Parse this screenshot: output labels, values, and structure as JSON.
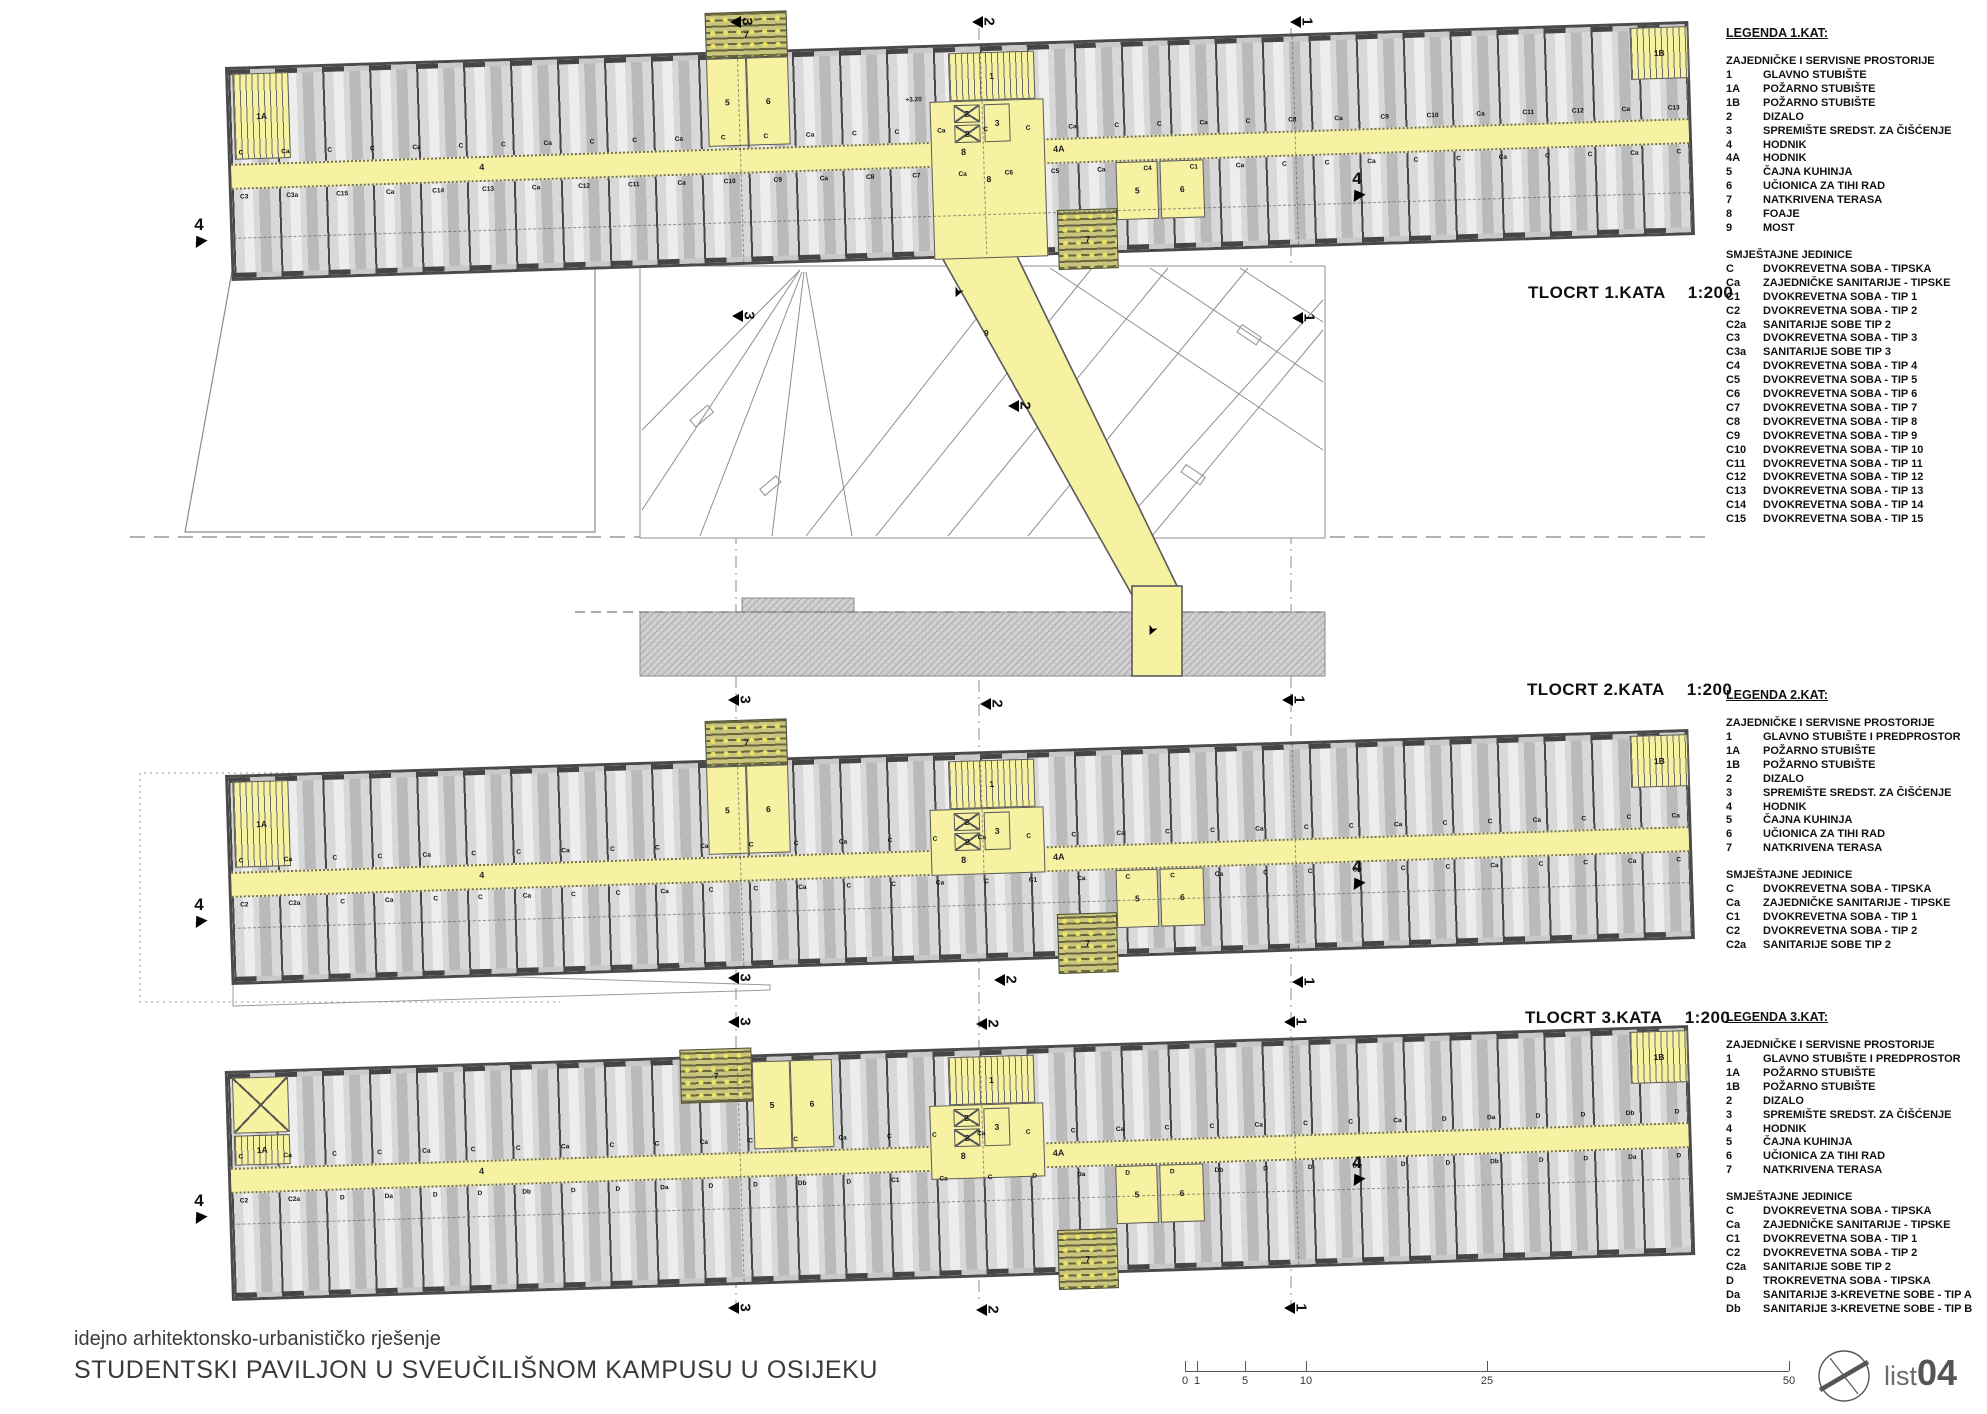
{
  "colors": {
    "accent_yellow": "#f7f2a2",
    "room_gray": "#d8d8d8",
    "terrace_olive": "#c9c47e",
    "wall_dark": "#4a4a4a"
  },
  "sheet": {
    "footer_line1": "idejno arhitektonsko-urbanističko rješenje",
    "footer_line2": "STUDENTSKI PAVILJON U SVEUČILIŠNOM KAMPUSU U OSIJEKU",
    "list_label": "list",
    "list_number": "04"
  },
  "site": {
    "bridge_room_label": "9"
  },
  "scalebar": {
    "ticks": [
      {
        "label": "0",
        "x": 0
      },
      {
        "label": "1",
        "x": 12
      },
      {
        "label": "5",
        "x": 60
      },
      {
        "label": "10",
        "x": 121
      },
      {
        "label": "25",
        "x": 302
      },
      {
        "label": "50",
        "x": 604
      }
    ]
  },
  "plans": [
    {
      "title": "TLOCRT  1.KATA",
      "scale": "1:200",
      "layout": {
        "left": 228,
        "top": 44,
        "width": 1464,
        "height": 214,
        "rot": -1.8,
        "title_x": 1528,
        "title_y": 283
      },
      "corridor_labels": [
        {
          "t": "4",
          "x": 248
        },
        {
          "t": "8",
          "x": 730
        },
        {
          "t": "4A",
          "x": 822
        }
      ],
      "top_labels": [
        "C",
        "Ca",
        "C",
        "C",
        "Ca",
        "C",
        "C",
        "Ca",
        "C",
        "C",
        "Ca",
        "C",
        "C",
        "Ca",
        "C",
        "C",
        "Ca",
        "C",
        "C",
        "Ca",
        "C",
        "C",
        "Ca",
        "C",
        "C8",
        "Ca",
        "C9",
        "C10",
        "Ca",
        "C11",
        "C12",
        "Ca",
        "C13"
      ],
      "bottom_labels": [
        "C3",
        "C3a",
        "C15",
        "Ca",
        "C14",
        "C13",
        "Ca",
        "C12",
        "C11",
        "Ca",
        "C10",
        "C9",
        "Ca",
        "C8",
        "C7",
        "Ca",
        "C6",
        "C5",
        "Ca",
        "C4",
        "C1",
        "Ca",
        "C",
        "C",
        "Ca",
        "C",
        "C",
        "Ca",
        "C",
        "C",
        "Ca",
        "C"
      ],
      "features": [
        {
          "type": "stair",
          "x": 4,
          "y": 4,
          "w": 56,
          "h": 86,
          "label": "1A"
        },
        {
          "type": "terrace",
          "x": 478,
          "y": -42,
          "w": 82,
          "h": 46,
          "label": "7"
        },
        {
          "type": "yellow",
          "x": 478,
          "y": 4,
          "w": 40,
          "h": 88,
          "label": "5"
        },
        {
          "type": "yellow",
          "x": 518,
          "y": 4,
          "w": 42,
          "h": 88,
          "label": "6"
        },
        {
          "type": "yellow",
          "x": 700,
          "y": 54,
          "w": 114,
          "h": 158,
          "label": "8"
        },
        {
          "type": "stair",
          "x": 720,
          "y": 6,
          "w": 86,
          "h": 48,
          "label": "1"
        },
        {
          "type": "elev",
          "x": 724,
          "y": 58,
          "w": 26,
          "h": 18,
          "label": "2"
        },
        {
          "type": "elev",
          "x": 724,
          "y": 78,
          "w": 26,
          "h": 18,
          "label": "2"
        },
        {
          "type": "yellow",
          "x": 754,
          "y": 58,
          "w": 26,
          "h": 38,
          "label": "3"
        },
        {
          "type": "text",
          "x": 676,
          "y": 48,
          "label": "+3.20"
        },
        {
          "type": "yellow",
          "x": 884,
          "y": 120,
          "w": 42,
          "h": 58,
          "label": "5"
        },
        {
          "type": "yellow",
          "x": 928,
          "y": 120,
          "w": 44,
          "h": 58,
          "label": "6"
        },
        {
          "type": "terrace",
          "x": 824,
          "y": 166,
          "w": 60,
          "h": 60,
          "label": "7"
        },
        {
          "type": "stair",
          "x": 1402,
          "y": 2,
          "w": 58,
          "h": 52,
          "label": "1B"
        }
      ],
      "section_x": [
        509,
        752,
        1064
      ],
      "section4_y": 168,
      "markers": [
        {
          "t": "3",
          "x": 730,
          "y": 14
        },
        {
          "t": "2",
          "x": 972,
          "y": 14
        },
        {
          "t": "1",
          "x": 1290,
          "y": 14
        },
        {
          "t": "3",
          "x": 732,
          "y": 308
        },
        {
          "t": "2",
          "x": 1008,
          "y": 398
        },
        {
          "t": "1",
          "x": 1292,
          "y": 310
        }
      ],
      "side_markers": [
        {
          "t": "4",
          "x": 186,
          "y": 216
        },
        {
          "t": "4",
          "x": 1344,
          "y": 170
        }
      ]
    },
    {
      "title": "TLOCRT  2.KATA",
      "scale": "1:200",
      "layout": {
        "left": 228,
        "top": 752,
        "width": 1464,
        "height": 210,
        "rot": -1.8,
        "title_x": 1527,
        "title_y": 680
      },
      "corridor_labels": [
        {
          "t": "4",
          "x": 248
        },
        {
          "t": "8",
          "x": 730
        },
        {
          "t": "4A",
          "x": 822
        }
      ],
      "top_labels": [
        "C",
        "Ca",
        "C",
        "C",
        "Ca",
        "C",
        "C",
        "Ca",
        "C",
        "C",
        "Ca",
        "C",
        "C",
        "Ca",
        "C",
        "C",
        "Ca",
        "C",
        "C",
        "Ca",
        "C",
        "C",
        "Ca",
        "C",
        "C",
        "Ca",
        "C",
        "C",
        "Ca",
        "C",
        "C",
        "Ca"
      ],
      "bottom_labels": [
        "C2",
        "C2a",
        "C",
        "Ca",
        "C",
        "C",
        "Ca",
        "C",
        "C",
        "Ca",
        "C",
        "C",
        "Ca",
        "C",
        "C",
        "Ca",
        "C",
        "C1",
        "Ca",
        "C",
        "C",
        "Ca",
        "C",
        "C",
        "Ca",
        "C",
        "C",
        "Ca",
        "C",
        "C",
        "Ca",
        "C"
      ],
      "features": [
        {
          "type": "stair",
          "x": 4,
          "y": 4,
          "w": 56,
          "h": 86,
          "label": "1A"
        },
        {
          "type": "terrace",
          "x": 478,
          "y": -42,
          "w": 82,
          "h": 46,
          "label": "7"
        },
        {
          "type": "yellow",
          "x": 478,
          "y": 4,
          "w": 40,
          "h": 88,
          "label": "5"
        },
        {
          "type": "yellow",
          "x": 518,
          "y": 4,
          "w": 42,
          "h": 88,
          "label": "6"
        },
        {
          "type": "yellow",
          "x": 700,
          "y": 54,
          "w": 114,
          "h": 66,
          "label": "8"
        },
        {
          "type": "stair",
          "x": 720,
          "y": 6,
          "w": 86,
          "h": 48,
          "label": "1"
        },
        {
          "type": "elev",
          "x": 724,
          "y": 58,
          "w": 26,
          "h": 18,
          "label": "2"
        },
        {
          "type": "elev",
          "x": 724,
          "y": 78,
          "w": 26,
          "h": 18,
          "label": "2"
        },
        {
          "type": "yellow",
          "x": 754,
          "y": 58,
          "w": 26,
          "h": 38,
          "label": "3"
        },
        {
          "type": "yellow",
          "x": 884,
          "y": 120,
          "w": 42,
          "h": 58,
          "label": "5"
        },
        {
          "type": "yellow",
          "x": 928,
          "y": 120,
          "w": 44,
          "h": 58,
          "label": "6"
        },
        {
          "type": "terrace",
          "x": 824,
          "y": 162,
          "w": 60,
          "h": 60,
          "label": "7"
        },
        {
          "type": "stair",
          "x": 1402,
          "y": 2,
          "w": 58,
          "h": 52,
          "label": "1B"
        }
      ],
      "section_x": [
        509,
        752,
        1064
      ],
      "section4_y": 150,
      "markers": [
        {
          "t": "3",
          "x": 728,
          "y": 692
        },
        {
          "t": "2",
          "x": 980,
          "y": 696
        },
        {
          "t": "1",
          "x": 1282,
          "y": 692
        },
        {
          "t": "3",
          "x": 728,
          "y": 970
        },
        {
          "t": "2",
          "x": 994,
          "y": 972
        },
        {
          "t": "1",
          "x": 1292,
          "y": 974
        }
      ],
      "side_markers": [
        {
          "t": "4",
          "x": 186,
          "y": 896
        },
        {
          "t": "4",
          "x": 1344,
          "y": 858
        }
      ]
    },
    {
      "title": "TLOCRT  3.KATA",
      "scale": "1:200",
      "layout": {
        "left": 228,
        "top": 1048,
        "width": 1464,
        "height": 230,
        "rot": -1.8,
        "title_x": 1525,
        "title_y": 1008
      },
      "corridor_labels": [
        {
          "t": "4",
          "x": 248
        },
        {
          "t": "8",
          "x": 730
        },
        {
          "t": "4A",
          "x": 822
        }
      ],
      "top_labels": [
        "C",
        "Ca",
        "C",
        "C",
        "Ca",
        "C",
        "C",
        "Ca",
        "C",
        "C",
        "Ca",
        "C",
        "C",
        "Ca",
        "C",
        "C",
        "Ca",
        "C",
        "C",
        "Ca",
        "C",
        "C",
        "Ca",
        "C",
        "C",
        "Ca",
        "D",
        "Da",
        "D",
        "D",
        "Db",
        "D"
      ],
      "bottom_labels": [
        "C2",
        "C2a",
        "D",
        "Da",
        "D",
        "D",
        "Db",
        "D",
        "D",
        "Da",
        "D",
        "D",
        "Db",
        "D",
        "C1",
        "Ca",
        "C",
        "D",
        "Da",
        "D",
        "D",
        "Db",
        "D",
        "D",
        "Da",
        "D",
        "D",
        "Db",
        "D",
        "D",
        "Da",
        "D"
      ],
      "features": [
        {
          "type": "xbox",
          "x": 4,
          "y": 4,
          "w": 56,
          "h": 56,
          "label": ""
        },
        {
          "type": "stair",
          "x": 4,
          "y": 62,
          "w": 56,
          "h": 30,
          "label": "1A"
        },
        {
          "type": "terrace",
          "x": 452,
          "y": -10,
          "w": 72,
          "h": 54,
          "label": "7"
        },
        {
          "type": "yellow",
          "x": 524,
          "y": 4,
          "w": 38,
          "h": 88,
          "label": "5"
        },
        {
          "type": "yellow",
          "x": 562,
          "y": 4,
          "w": 42,
          "h": 88,
          "label": "6"
        },
        {
          "type": "yellow",
          "x": 700,
          "y": 54,
          "w": 114,
          "h": 74,
          "label": "8"
        },
        {
          "type": "stair",
          "x": 720,
          "y": 6,
          "w": 86,
          "h": 48,
          "label": "1"
        },
        {
          "type": "elev",
          "x": 724,
          "y": 58,
          "w": 26,
          "h": 18,
          "label": "2"
        },
        {
          "type": "elev",
          "x": 724,
          "y": 78,
          "w": 26,
          "h": 18,
          "label": "2"
        },
        {
          "type": "yellow",
          "x": 754,
          "y": 58,
          "w": 26,
          "h": 38,
          "label": "3"
        },
        {
          "type": "yellow",
          "x": 884,
          "y": 120,
          "w": 42,
          "h": 58,
          "label": "5"
        },
        {
          "type": "yellow",
          "x": 928,
          "y": 120,
          "w": 44,
          "h": 58,
          "label": "6"
        },
        {
          "type": "terrace",
          "x": 824,
          "y": 182,
          "w": 60,
          "h": 60,
          "label": "7"
        },
        {
          "type": "stair",
          "x": 1402,
          "y": 2,
          "w": 58,
          "h": 52,
          "label": "1B"
        }
      ],
      "section_x": [
        509,
        752,
        1064
      ],
      "section4_y": 150,
      "markers": [
        {
          "t": "3",
          "x": 728,
          "y": 1014
        },
        {
          "t": "2",
          "x": 976,
          "y": 1016
        },
        {
          "t": "1",
          "x": 1284,
          "y": 1014
        },
        {
          "t": "3",
          "x": 728,
          "y": 1300
        },
        {
          "t": "2",
          "x": 976,
          "y": 1302
        },
        {
          "t": "1",
          "x": 1284,
          "y": 1300
        }
      ],
      "side_markers": [
        {
          "t": "4",
          "x": 186,
          "y": 1192
        },
        {
          "t": "4",
          "x": 1344,
          "y": 1154
        }
      ]
    }
  ],
  "legends": [
    {
      "title": "LEGENDA 1.KAT:",
      "top": 26,
      "sections": [
        {
          "head": "ZAJEDNIČKE I SERVISNE PROSTORIJE",
          "items": [
            [
              "1",
              "GLAVNO STUBIŠTE"
            ],
            [
              "1A",
              "POŽARNO STUBIŠTE"
            ],
            [
              "1B",
              "POŽARNO STUBIŠTE"
            ],
            [
              "2",
              "DIZALO"
            ],
            [
              "3",
              "SPREMIŠTE SREDST. ZA ČIŠĆENJE"
            ],
            [
              "4",
              "HODNIK"
            ],
            [
              "4A",
              "HODNIK"
            ],
            [
              "5",
              "ČAJNA KUHINJA"
            ],
            [
              "6",
              "UČIONICA ZA TIHI RAD"
            ],
            [
              "7",
              "NATKRIVENA TERASA"
            ],
            [
              "8",
              "FOAJE"
            ],
            [
              "9",
              "MOST"
            ]
          ]
        },
        {
          "head": "SMJEŠTAJNE JEDINICE",
          "items": [
            [
              "C",
              "DVOKREVETNA SOBA - TIPSKA"
            ],
            [
              "Ca",
              "ZAJEDNIČKE SANITARIJE - TIPSKE"
            ],
            [
              "C1",
              "DVOKREVETNA SOBA - TIP 1"
            ],
            [
              "C2",
              "DVOKREVETNA SOBA - TIP 2"
            ],
            [
              "C2a",
              "SANITARIJE SOBE TIP 2"
            ],
            [
              "C3",
              "DVOKREVETNA SOBA - TIP 3"
            ],
            [
              "C3a",
              "SANITARIJE SOBE TIP 3"
            ],
            [
              "C4",
              "DVOKREVETNA SOBA - TIP 4"
            ],
            [
              "C5",
              "DVOKREVETNA SOBA - TIP 5"
            ],
            [
              "C6",
              "DVOKREVETNA SOBA - TIP 6"
            ],
            [
              "C7",
              "DVOKREVETNA SOBA - TIP 7"
            ],
            [
              "C8",
              "DVOKREVETNA SOBA - TIP 8"
            ],
            [
              "C9",
              "DVOKREVETNA SOBA - TIP 9"
            ],
            [
              "C10",
              "DVOKREVETNA SOBA - TIP 10"
            ],
            [
              "C11",
              "DVOKREVETNA SOBA - TIP 11"
            ],
            [
              "C12",
              "DVOKREVETNA SOBA - TIP 12"
            ],
            [
              "C13",
              "DVOKREVETNA SOBA - TIP 13"
            ],
            [
              "C14",
              "DVOKREVETNA SOBA - TIP 14"
            ],
            [
              "C15",
              "DVOKREVETNA SOBA - TIP 15"
            ]
          ]
        }
      ]
    },
    {
      "title": "LEGENDA 2.KAT:",
      "top": 688,
      "sections": [
        {
          "head": "ZAJEDNIČKE I SERVISNE PROSTORIJE",
          "items": [
            [
              "1",
              "GLAVNO STUBIŠTE I PREDPROSTOR"
            ],
            [
              "1A",
              "POŽARNO STUBIŠTE"
            ],
            [
              "1B",
              "POŽARNO STUBIŠTE"
            ],
            [
              "2",
              "DIZALO"
            ],
            [
              "3",
              "SPREMIŠTE SREDST. ZA ČIŠĆENJE"
            ],
            [
              "4",
              "HODNIK"
            ],
            [
              "5",
              "ČAJNA KUHINJA"
            ],
            [
              "6",
              "UČIONICA ZA TIHI RAD"
            ],
            [
              "7",
              "NATKRIVENA TERASA"
            ]
          ]
        },
        {
          "head": "SMJEŠTAJNE JEDINICE",
          "items": [
            [
              "C",
              "DVOKREVETNA SOBA - TIPSKA"
            ],
            [
              "Ca",
              "ZAJEDNIČKE SANITARIJE - TIPSKE"
            ],
            [
              "C1",
              "DVOKREVETNA SOBA - TIP 1"
            ],
            [
              "C2",
              "DVOKREVETNA SOBA - TIP 2"
            ],
            [
              "C2a",
              "SANITARIJE SOBE TIP 2"
            ]
          ]
        }
      ]
    },
    {
      "title": "LEGENDA 3.KAT:",
      "top": 1010,
      "sections": [
        {
          "head": "ZAJEDNIČKE I SERVISNE PROSTORIJE",
          "items": [
            [
              "1",
              "GLAVNO STUBIŠTE I PREDPROSTOR"
            ],
            [
              "1A",
              "POŽARNO STUBIŠTE"
            ],
            [
              "1B",
              "POŽARNO STUBIŠTE"
            ],
            [
              "2",
              "DIZALO"
            ],
            [
              "3",
              "SPREMIŠTE SREDST. ZA ČIŠĆENJE"
            ],
            [
              "4",
              "HODNIK"
            ],
            [
              "5",
              "ČAJNA KUHINJA"
            ],
            [
              "6",
              "UČIONICA ZA TIHI RAD"
            ],
            [
              "7",
              "NATKRIVENA TERASA"
            ]
          ]
        },
        {
          "head": "SMJEŠTAJNE JEDINICE",
          "items": [
            [
              "C",
              "DVOKREVETNA SOBA - TIPSKA"
            ],
            [
              "Ca",
              "ZAJEDNIČKE SANITARIJE - TIPSKE"
            ],
            [
              "C1",
              "DVOKREVETNA SOBA - TIP 1"
            ],
            [
              "C2",
              "DVOKREVETNA SOBA - TIP 2"
            ],
            [
              "C2a",
              "SANITARIJE SOBE TIP 2"
            ],
            [
              "D",
              "TROKREVETNA SOBA - TIPSKA"
            ],
            [
              "Da",
              "SANITARIJE 3-KREVETNE SOBE - TIP A"
            ],
            [
              "Db",
              "SANITARIJE 3-KREVETNE SOBE - TIP B"
            ]
          ]
        }
      ]
    }
  ]
}
